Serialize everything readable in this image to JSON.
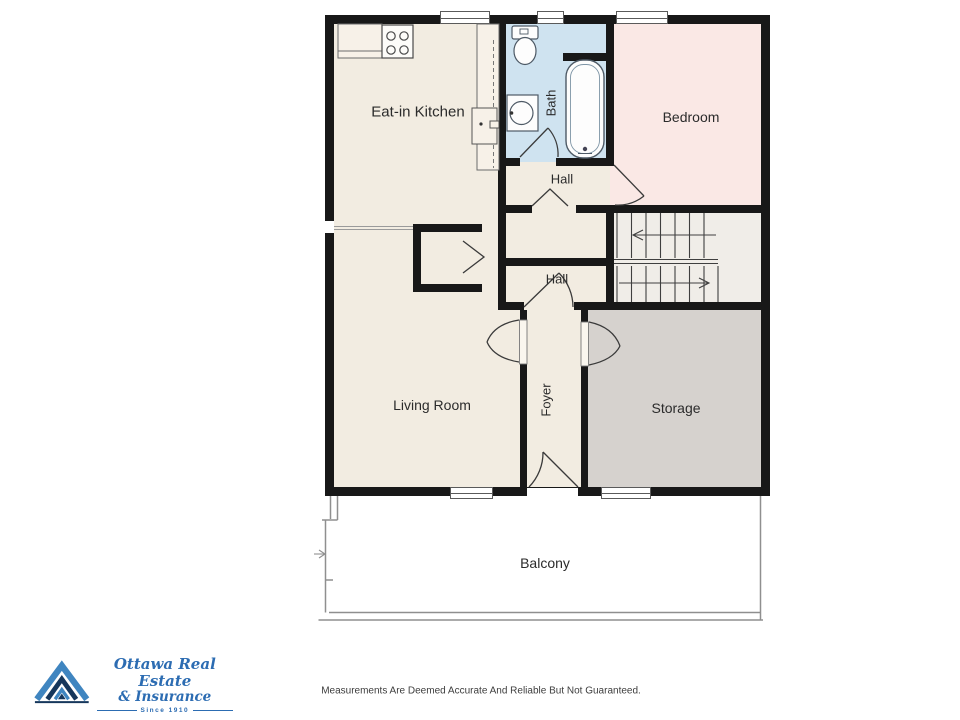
{
  "rooms": {
    "kitchen": {
      "label": "Eat-in Kitchen"
    },
    "bath": {
      "label": "Bath"
    },
    "bedroom": {
      "label": "Bedroom"
    },
    "hall_upper": {
      "label": "Hall"
    },
    "hall_lower": {
      "label": "Hall"
    },
    "living": {
      "label": "Living Room"
    },
    "foyer": {
      "label": "Foyer"
    },
    "storage": {
      "label": "Storage"
    },
    "balcony": {
      "label": "Balcony"
    }
  },
  "branding": {
    "name_line1": "Ottawa Real Estate",
    "name_line2": "& Insurance",
    "tagline": "Since 1910",
    "brand_blue": "#2c6cb2",
    "brand_navy": "#16375c"
  },
  "footer": {
    "disclaimer": "Measurements Are Deemed Accurate And Reliable But Not Guaranteed."
  },
  "colors": {
    "floor_cream": "#f2ece1",
    "bath_blue": "#cfe3f0",
    "bedroom_pink": "#fae8e5",
    "storage_gray": "#d6d2ce",
    "stairs_offwhite": "#f0ede8",
    "wall_black": "#181818"
  }
}
